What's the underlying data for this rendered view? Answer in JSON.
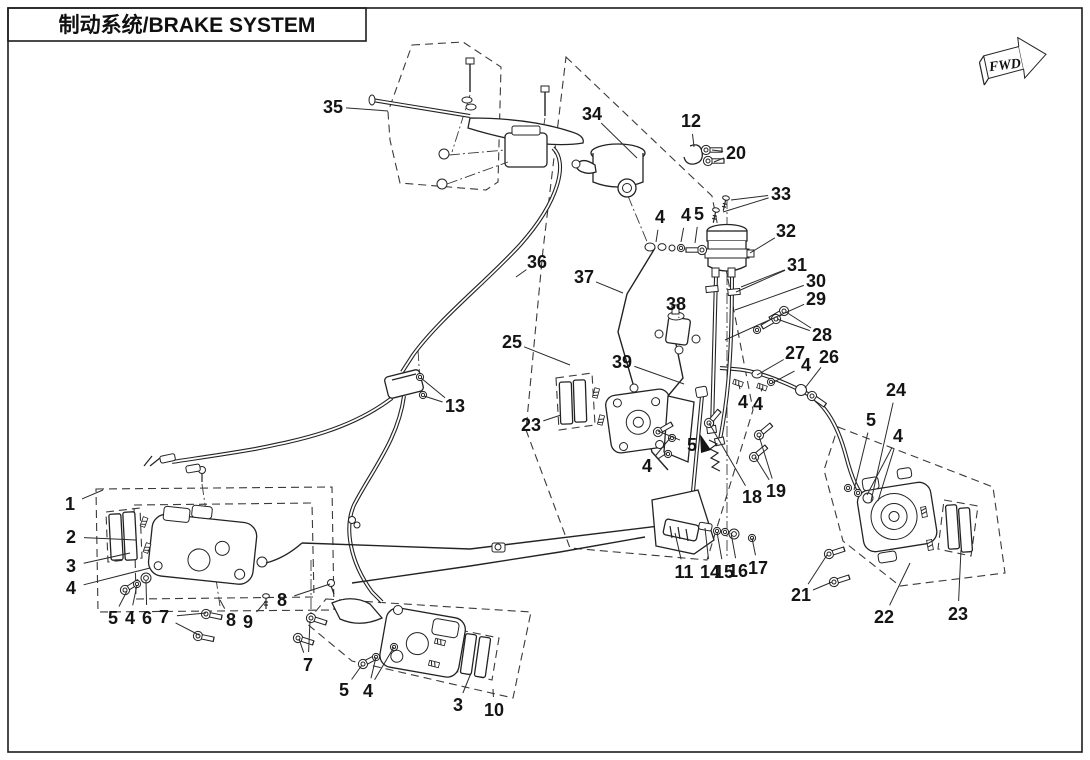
{
  "title_block": {
    "title": "制动系统/BRAKE SYSTEM"
  },
  "direction_marker": {
    "label": "FWD"
  },
  "colors": {
    "line": "#232323",
    "background": "#ffffff"
  },
  "diagram": {
    "description": "Exploded parts diagram of brake system with numbered callouts",
    "callouts": [
      {
        "num": "35",
        "x": 333,
        "y": 107,
        "leads": [
          [
            388,
            111
          ]
        ]
      },
      {
        "num": "34",
        "x": 592,
        "y": 114,
        "leads": [
          [
            637,
            158
          ]
        ]
      },
      {
        "num": "12",
        "x": 691,
        "y": 121,
        "leads": [
          [
            694,
            147
          ]
        ]
      },
      {
        "num": "20",
        "x": 736,
        "y": 153,
        "leads": [
          [
            712,
            150
          ],
          [
            714,
            162
          ]
        ]
      },
      {
        "num": "33",
        "x": 781,
        "y": 194,
        "leads": [
          [
            731,
            200
          ],
          [
            723,
            212
          ]
        ]
      },
      {
        "num": "32",
        "x": 786,
        "y": 231,
        "leads": [
          [
            750,
            253
          ]
        ]
      },
      {
        "num": "4",
        "x": 660,
        "y": 217,
        "leads": [
          [
            656,
            242
          ]
        ]
      },
      {
        "num": "4",
        "x": 686,
        "y": 215,
        "leads": [
          [
            681,
            242
          ]
        ]
      },
      {
        "num": "5",
        "x": 699,
        "y": 214,
        "leads": [
          [
            695,
            243
          ]
        ]
      },
      {
        "num": "31",
        "x": 797,
        "y": 265,
        "leads": [
          [
            741,
            287
          ],
          [
            736,
            292
          ]
        ]
      },
      {
        "num": "30",
        "x": 816,
        "y": 281,
        "leads": [
          [
            735,
            310
          ]
        ]
      },
      {
        "num": "29",
        "x": 816,
        "y": 299,
        "leads": [
          [
            725,
            340
          ]
        ]
      },
      {
        "num": "28",
        "x": 822,
        "y": 335,
        "leads": [
          [
            786,
            312
          ],
          [
            777,
            319
          ]
        ]
      },
      {
        "num": "37",
        "x": 584,
        "y": 277,
        "leads": [
          [
            623,
            293
          ]
        ]
      },
      {
        "num": "36",
        "x": 537,
        "y": 262,
        "leads": [
          [
            516,
            277
          ]
        ]
      },
      {
        "num": "38",
        "x": 676,
        "y": 304,
        "leads": [
          [
            679,
            318
          ]
        ]
      },
      {
        "num": "25",
        "x": 512,
        "y": 342,
        "leads": [
          [
            570,
            365
          ]
        ]
      },
      {
        "num": "39",
        "x": 622,
        "y": 362,
        "leads": [
          [
            684,
            384
          ]
        ]
      },
      {
        "num": "27",
        "x": 795,
        "y": 353,
        "leads": [
          [
            757,
            375
          ]
        ]
      },
      {
        "num": "4",
        "x": 806,
        "y": 365,
        "leads": [
          [
            772,
            383
          ]
        ]
      },
      {
        "num": "26",
        "x": 829,
        "y": 357,
        "leads": [
          [
            805,
            388
          ]
        ]
      },
      {
        "num": "24",
        "x": 896,
        "y": 390,
        "leads": [
          [
            871,
            501
          ]
        ]
      },
      {
        "num": "5",
        "x": 871,
        "y": 420,
        "leads": [
          [
            854,
            490
          ]
        ]
      },
      {
        "num": "4",
        "x": 898,
        "y": 436,
        "leads": [
          [
            867,
            495
          ],
          [
            878,
            501
          ]
        ]
      },
      {
        "num": "13",
        "x": 455,
        "y": 406,
        "leads": [
          [
            421,
            378
          ],
          [
            424,
            396
          ]
        ]
      },
      {
        "num": "23",
        "x": 531,
        "y": 425,
        "leads": [
          [
            561,
            415
          ]
        ]
      },
      {
        "num": "5",
        "x": 692,
        "y": 445,
        "leads": [
          [
            658,
            431
          ]
        ]
      },
      {
        "num": "4",
        "x": 647,
        "y": 466,
        "leads": [
          [
            671,
            437
          ],
          [
            667,
            453
          ]
        ]
      },
      {
        "num": "4",
        "x": 743,
        "y": 402,
        "leads": [
          [
            739,
            385
          ]
        ]
      },
      {
        "num": "4",
        "x": 758,
        "y": 404,
        "leads": [
          [
            762,
            388
          ]
        ]
      },
      {
        "num": "18",
        "x": 752,
        "y": 497,
        "leads": [
          [
            709,
            423
          ]
        ]
      },
      {
        "num": "19",
        "x": 776,
        "y": 491,
        "leads": [
          [
            759,
            436
          ],
          [
            755,
            457
          ]
        ]
      },
      {
        "num": "1",
        "x": 70,
        "y": 504,
        "leads": [
          [
            103,
            490
          ]
        ]
      },
      {
        "num": "2",
        "x": 71,
        "y": 537,
        "leads": [
          [
            136,
            540
          ]
        ]
      },
      {
        "num": "3",
        "x": 71,
        "y": 566,
        "leads": [
          [
            130,
            553
          ]
        ]
      },
      {
        "num": "4",
        "x": 71,
        "y": 588,
        "leads": [
          [
            150,
            568
          ]
        ]
      },
      {
        "num": "5",
        "x": 113,
        "y": 618,
        "leads": [
          [
            127,
            591
          ]
        ]
      },
      {
        "num": "4",
        "x": 130,
        "y": 618,
        "leads": [
          [
            137,
            585
          ]
        ]
      },
      {
        "num": "6",
        "x": 147,
        "y": 618,
        "leads": [
          [
            146,
            581
          ]
        ]
      },
      {
        "num": "7",
        "x": 164,
        "y": 617,
        "leads": [
          [
            206,
            613
          ],
          [
            199,
            635
          ]
        ]
      },
      {
        "num": "8",
        "x": 231,
        "y": 620,
        "leads": [
          [
            220,
            600
          ]
        ]
      },
      {
        "num": "9",
        "x": 248,
        "y": 622,
        "leads": [
          [
            266,
            601
          ]
        ]
      },
      {
        "num": "8",
        "x": 282,
        "y": 600,
        "leads": [
          [
            330,
            584
          ]
        ]
      },
      {
        "num": "7",
        "x": 308,
        "y": 665,
        "leads": [
          [
            310,
            621
          ],
          [
            299,
            639
          ]
        ]
      },
      {
        "num": "5",
        "x": 344,
        "y": 690,
        "leads": [
          [
            362,
            665
          ]
        ]
      },
      {
        "num": "4",
        "x": 368,
        "y": 691,
        "leads": [
          [
            376,
            657
          ],
          [
            394,
            647
          ]
        ]
      },
      {
        "num": "3",
        "x": 458,
        "y": 705,
        "leads": [
          [
            471,
            673
          ]
        ]
      },
      {
        "num": "10",
        "x": 494,
        "y": 710,
        "leads": [
          [
            493,
            689
          ]
        ]
      },
      {
        "num": "11",
        "x": 684,
        "y": 572,
        "leads": [
          [
            675,
            533
          ]
        ]
      },
      {
        "num": "14",
        "x": 710,
        "y": 572,
        "leads": [
          [
            705,
            528
          ]
        ]
      },
      {
        "num": "15",
        "x": 724,
        "y": 572,
        "leads": [
          [
            717,
            532
          ]
        ]
      },
      {
        "num": "16",
        "x": 738,
        "y": 571,
        "leads": [
          [
            731,
            533
          ]
        ]
      },
      {
        "num": "17",
        "x": 758,
        "y": 568,
        "leads": [
          [
            752,
            538
          ]
        ]
      },
      {
        "num": "21",
        "x": 801,
        "y": 595,
        "leads": [
          [
            827,
            555
          ],
          [
            832,
            582
          ]
        ]
      },
      {
        "num": "22",
        "x": 884,
        "y": 617,
        "leads": [
          [
            910,
            563
          ]
        ]
      },
      {
        "num": "23",
        "x": 958,
        "y": 614,
        "leads": [
          [
            961,
            550
          ]
        ]
      }
    ]
  }
}
